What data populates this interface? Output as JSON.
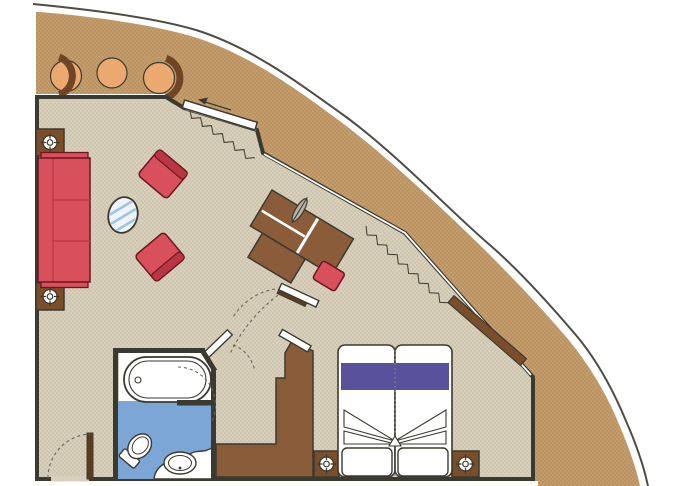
{
  "meta": {
    "description": "Cruise ship suite floor plan with private balcony, living room, bedroom, bathroom and curved open deck"
  },
  "palette": {
    "white": "#ffffff",
    "hull": "#4e4c44",
    "wall": "#3b3a30",
    "deck": "#c49d6d",
    "deckDot": "#ad8454",
    "floor": "#d8d0bc",
    "floorDot": "#c2b69d",
    "woodMid": "#8a5c39",
    "woodEnd": "#7b4e2a",
    "woodDark": "#5e3a1f",
    "deckPanel": "#7a4e2b",
    "red": "#d8505c",
    "redTrim": "#b93745",
    "redDark": "#6e1620",
    "orange": "#eca96f",
    "orangeBack": "#6f4526",
    "purple": "#59519c",
    "bathBlue": "#7ba6d6",
    "glassStripe": "#9fc3e0",
    "glassFill": "#eef4f9",
    "lamp": "#b9b2a4",
    "dash": "#6a665c"
  },
  "rooms": [
    {
      "name": "open-deck"
    },
    {
      "name": "balcony"
    },
    {
      "name": "living-room"
    },
    {
      "name": "dressing-area"
    },
    {
      "name": "bedroom"
    },
    {
      "name": "bathroom"
    }
  ],
  "furniture": [
    {
      "name": "sofa",
      "room": "living-room"
    },
    {
      "name": "armchair",
      "room": "living-room",
      "count": 2
    },
    {
      "name": "oval-glass-table",
      "room": "living-room"
    },
    {
      "name": "side-table",
      "room": "living-room",
      "count": 2
    },
    {
      "name": "balcony-chair",
      "room": "balcony",
      "count": 2
    },
    {
      "name": "balcony-table",
      "room": "balcony"
    },
    {
      "name": "desk-unit",
      "room": "living-room"
    },
    {
      "name": "desk-lamp",
      "room": "living-room"
    },
    {
      "name": "desk-stool",
      "room": "living-room"
    },
    {
      "name": "sliding-glass-door",
      "room": "living-room",
      "count": 2
    },
    {
      "name": "stepped-wardrobe",
      "room": "dressing-area"
    },
    {
      "name": "double-bed",
      "room": "bedroom"
    },
    {
      "name": "nightstand",
      "room": "bedroom",
      "count": 2
    },
    {
      "name": "bed-foot-cushion",
      "room": "bedroom",
      "count": 2
    },
    {
      "name": "bathtub",
      "room": "bathroom"
    },
    {
      "name": "toilet",
      "room": "bathroom"
    },
    {
      "name": "vanity-sink",
      "room": "bathroom"
    },
    {
      "name": "entry-door",
      "room": "living-room"
    },
    {
      "name": "interior-door",
      "room": "dressing-area",
      "count": 3
    }
  ],
  "symbols": [
    {
      "name": "ceiling-light-symbol",
      "count": 4
    },
    {
      "name": "door-swing-arc",
      "count": 6
    },
    {
      "name": "curtain-zigzag",
      "count": 2
    },
    {
      "name": "slide-direction-arrow",
      "count": 1
    }
  ]
}
